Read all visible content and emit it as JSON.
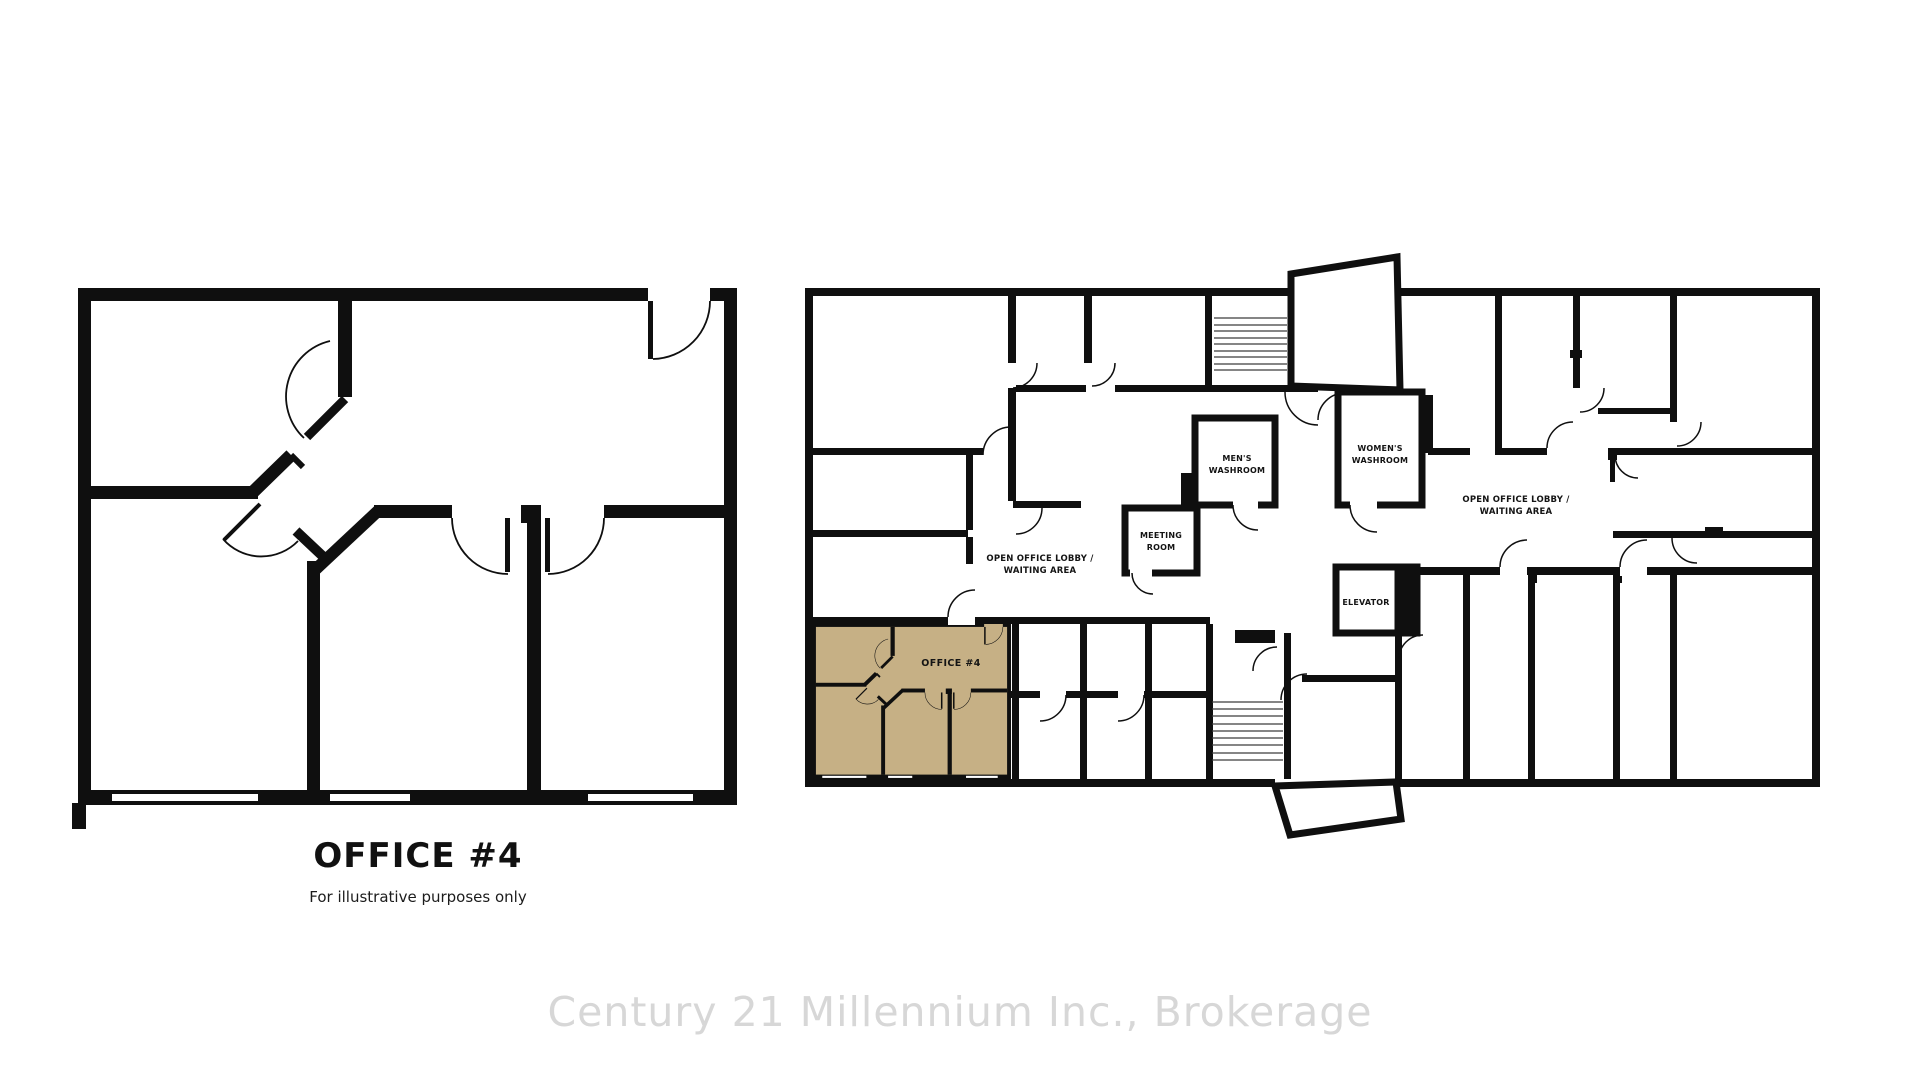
{
  "left_panel": {
    "title": "OFFICE #4",
    "subtitle": "For illustrative purposes only"
  },
  "right_plan": {
    "highlight_color": "#c6b085",
    "labels": {
      "mens_washroom": {
        "line1": "MEN'S",
        "line2": "WASHROOM"
      },
      "womens_washroom": {
        "line1": "WOMEN'S",
        "line2": "WASHROOM"
      },
      "meeting_room": {
        "line1": "MEETING",
        "line2": "ROOM"
      },
      "open_office_left": {
        "line1": "OPEN OFFICE LOBBY /",
        "line2": "WAITING AREA"
      },
      "open_office_right": {
        "line1": "OPEN OFFICE LOBBY /",
        "line2": "WAITING AREA"
      },
      "elevator": "ELEVATOR",
      "office_unit": "OFFICE #4"
    }
  },
  "watermark": {
    "text": "Century 21 Millennium Inc., Brokerage",
    "color": "#d7d7d7"
  },
  "colors": {
    "wall": "#0f0f0f",
    "background": "#ffffff"
  }
}
